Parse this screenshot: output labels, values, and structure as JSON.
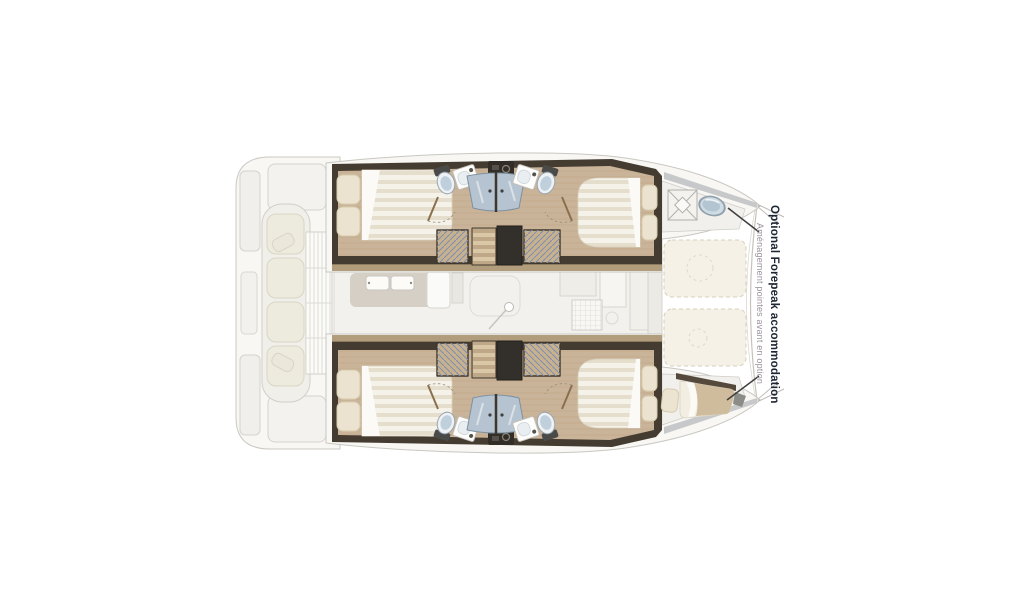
{
  "diagram": {
    "type": "catamaran-interior-floor-plan",
    "annotation": {
      "en": "Optional Forepeak accommodation",
      "fr": "Aménagement pointes avant en option"
    },
    "colors": {
      "background": "#ffffff",
      "wood_floor": "#cab499",
      "hull_wall": "#453c31",
      "bed_linen": "#f5f2e9",
      "pillow": "#ebe3cf",
      "shower_glass": "#b5c4d0",
      "trampoline": "#f5f1e6",
      "faded_deck": "#f8f7f4",
      "annotation_primary": "#1e2633",
      "annotation_secondary": "#9a929c",
      "arrow": "#3f3f3f"
    }
  }
}
